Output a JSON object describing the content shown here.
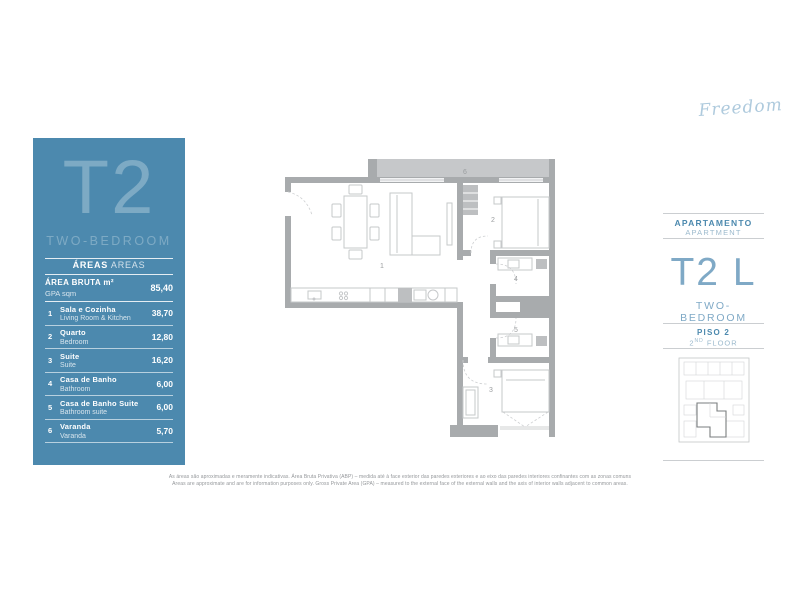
{
  "logo": {
    "text": "Freedom"
  },
  "left_panel": {
    "type_code": "T2",
    "type_label": "TWO-BEDROOM",
    "areas_header": {
      "pt": "ÁREAS",
      "en": "AREAS"
    },
    "gross_area": {
      "label_pt": "ÁREA BRUTA m²",
      "label_en": "GPA sqm",
      "value": "85,40"
    },
    "rows": [
      {
        "num": "1",
        "pt": "Sala e Cozinha",
        "en": "Living Room & Kitchen",
        "value": "38,70"
      },
      {
        "num": "2",
        "pt": "Quarto",
        "en": "Bedroom",
        "value": "12,80"
      },
      {
        "num": "3",
        "pt": "Suite",
        "en": "Suite",
        "value": "16,20"
      },
      {
        "num": "4",
        "pt": "Casa de Banho",
        "en": "Bathroom",
        "value": "6,00"
      },
      {
        "num": "5",
        "pt": "Casa de Banho Suite",
        "en": "Bathroom suite",
        "value": "6,00"
      },
      {
        "num": "6",
        "pt": "Varanda",
        "en": "Varanda",
        "value": "5,70"
      }
    ]
  },
  "right_panel": {
    "apartment_label_pt": "APARTAMENTO",
    "apartment_label_en": "APARTMENT",
    "unit_code": "T2 L",
    "unit_type": "TWO-BEDROOM",
    "floor_pt": "PISO 2",
    "floor_en_num": "2",
    "floor_en_sup": "ND",
    "floor_en_word": "FLOOR"
  },
  "floorplan": {
    "room_numbers": {
      "living": "1",
      "bedroom": "2",
      "suite": "3",
      "bathroom": "4",
      "bathroom_suite": "5",
      "balcony": "6"
    }
  },
  "footer": {
    "line_pt": "As áreas são aproximadas e meramente indicativas. Área Bruta Privativa (ABP) – medida até à face exterior das paredes exteriores e ao eixo das paredes interiores confinantes com as zonas comuns",
    "line_en": "Areas are approximate and are for information purposes only. Gross Private Area (GPA) – measured to the external face of the external walls and the axis of interior walls adjacent to common areas."
  },
  "colors": {
    "panel_blue": "#4c89ae",
    "accent_light_blue": "#7fa9c6",
    "wall_gray": "#a8abad"
  }
}
